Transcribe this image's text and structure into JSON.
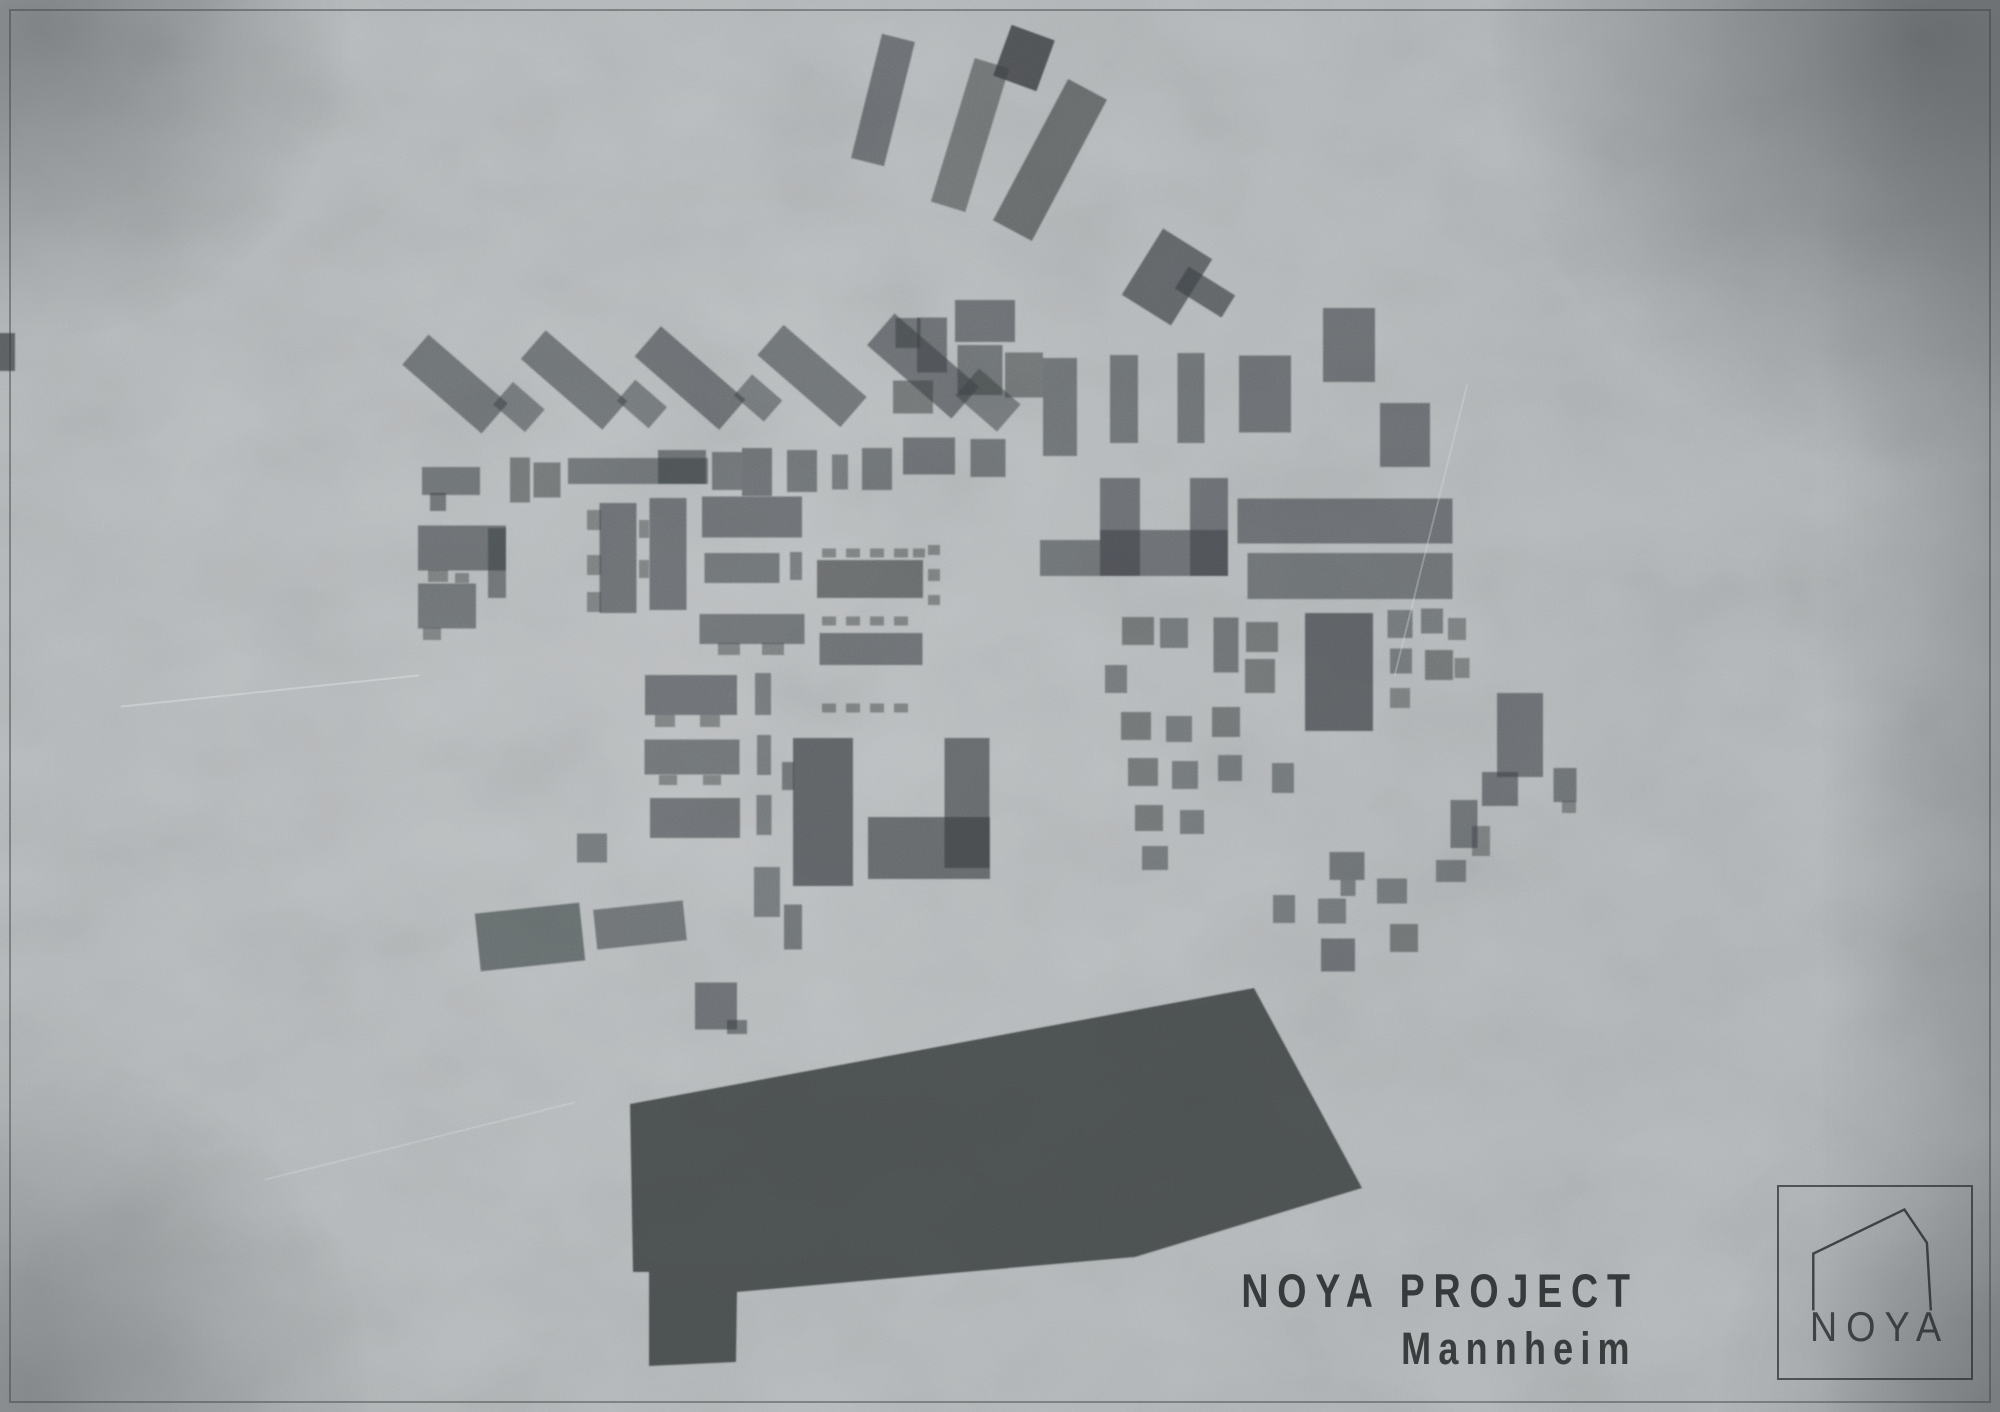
{
  "project": {
    "title": "NOYA PROJECT",
    "subtitle": "Mannheim"
  },
  "logo": {
    "text": "NOYA"
  },
  "colors": {
    "background": "#b4b8ba",
    "building": "#3c4043",
    "building_dark": "#2f3336",
    "ink": "#26292b",
    "frame": "#3b3e41"
  },
  "map": {
    "description": "figure-ground site plan of building footprints",
    "building_format": "[cx, cy, w, h, rotation_deg, opacity]",
    "buildings": [
      [
        883,
        100,
        34,
        128,
        14,
        0.62
      ],
      [
        970,
        135,
        36,
        150,
        17,
        0.58
      ],
      [
        1024,
        58,
        46,
        54,
        20,
        0.85
      ],
      [
        1050,
        160,
        44,
        160,
        28,
        0.66
      ],
      [
        1167,
        277,
        58,
        78,
        32,
        0.7
      ],
      [
        1205,
        292,
        55,
        26,
        32,
        0.7
      ],
      [
        455,
        384,
        105,
        40,
        41,
        0.6
      ],
      [
        519,
        407,
        42,
        30,
        41,
        0.55
      ],
      [
        574,
        380,
        108,
        38,
        41,
        0.6
      ],
      [
        642,
        404,
        42,
        28,
        41,
        0.55
      ],
      [
        690,
        378,
        112,
        40,
        41,
        0.62
      ],
      [
        758,
        398,
        40,
        28,
        41,
        0.55
      ],
      [
        812,
        376,
        110,
        40,
        41,
        0.6
      ],
      [
        923,
        366,
        112,
        42,
        41,
        0.62
      ],
      [
        988,
        400,
        55,
        36,
        41,
        0.55
      ],
      [
        908,
        333,
        25,
        30,
        0,
        0.6
      ],
      [
        932,
        345,
        30,
        55,
        0,
        0.62
      ],
      [
        985,
        321,
        60,
        42,
        0,
        0.62
      ],
      [
        980,
        370,
        45,
        50,
        0,
        0.6
      ],
      [
        1024,
        375,
        38,
        45,
        0,
        0.58
      ],
      [
        913,
        397,
        40,
        33,
        0,
        0.58
      ],
      [
        1060,
        407,
        34,
        98,
        0,
        0.6
      ],
      [
        1124,
        399,
        28,
        88,
        0,
        0.6
      ],
      [
        1191,
        398,
        27,
        90,
        0,
        0.6
      ],
      [
        1265,
        394,
        52,
        77,
        0,
        0.62
      ],
      [
        1349,
        345,
        52,
        74,
        0,
        0.62
      ],
      [
        1405,
        435,
        50,
        64,
        0,
        0.62
      ],
      [
        451,
        481,
        58,
        28,
        0,
        0.6
      ],
      [
        438,
        502,
        16,
        18,
        0,
        0.6
      ],
      [
        520,
        480,
        20,
        45,
        0,
        0.58
      ],
      [
        547,
        480,
        27,
        35,
        0,
        0.58
      ],
      [
        638,
        471,
        140,
        26,
        0,
        0.6
      ],
      [
        682,
        467,
        48,
        34,
        0,
        0.62
      ],
      [
        727,
        471,
        30,
        38,
        0,
        0.6
      ],
      [
        757,
        472,
        30,
        48,
        0,
        0.62
      ],
      [
        802,
        471,
        30,
        42,
        0,
        0.6
      ],
      [
        840,
        472,
        16,
        35,
        0,
        0.55
      ],
      [
        877,
        469,
        30,
        42,
        0,
        0.6
      ],
      [
        929,
        456,
        52,
        37,
        0,
        0.62
      ],
      [
        988,
        458,
        35,
        38,
        0,
        0.6
      ],
      [
        462,
        548,
        88,
        45,
        0,
        0.62
      ],
      [
        497,
        563,
        18,
        70,
        0,
        0.6
      ],
      [
        447,
        606,
        58,
        45,
        0,
        0.6
      ],
      [
        438,
        576,
        20,
        12,
        0,
        0.5
      ],
      [
        462,
        578,
        14,
        10,
        0,
        0.5
      ],
      [
        432,
        634,
        18,
        12,
        0,
        0.5
      ],
      [
        618,
        558,
        37,
        110,
        0,
        0.62
      ],
      [
        594,
        520,
        14,
        20,
        0,
        0.5
      ],
      [
        594,
        565,
        14,
        20,
        0,
        0.5
      ],
      [
        594,
        602,
        14,
        20,
        0,
        0.5
      ],
      [
        668,
        554,
        37,
        112,
        0,
        0.62
      ],
      [
        644,
        529,
        10,
        18,
        0,
        0.5
      ],
      [
        644,
        569,
        10,
        18,
        0,
        0.5
      ],
      [
        752,
        517,
        100,
        41,
        0,
        0.62
      ],
      [
        742,
        568,
        75,
        30,
        0,
        0.6
      ],
      [
        796,
        566,
        12,
        28,
        0,
        0.55
      ],
      [
        752,
        629,
        105,
        30,
        0,
        0.6
      ],
      [
        729,
        649,
        22,
        12,
        0,
        0.5
      ],
      [
        773,
        649,
        22,
        12,
        0,
        0.5
      ],
      [
        691,
        695,
        92,
        40,
        0,
        0.62
      ],
      [
        665,
        721,
        20,
        12,
        0,
        0.5
      ],
      [
        710,
        721,
        20,
        12,
        0,
        0.5
      ],
      [
        763,
        694,
        16,
        42,
        0,
        0.55
      ],
      [
        692,
        757,
        95,
        35,
        0,
        0.6
      ],
      [
        668,
        780,
        18,
        10,
        0,
        0.5
      ],
      [
        712,
        780,
        18,
        10,
        0,
        0.5
      ],
      [
        764,
        755,
        14,
        40,
        0,
        0.55
      ],
      [
        695,
        818,
        90,
        40,
        0,
        0.62
      ],
      [
        764,
        815,
        15,
        40,
        0,
        0.55
      ],
      [
        829,
        553,
        14,
        9,
        0,
        0.5
      ],
      [
        853,
        553,
        14,
        9,
        0,
        0.5
      ],
      [
        877,
        553,
        14,
        9,
        0,
        0.5
      ],
      [
        901,
        553,
        14,
        9,
        0,
        0.5
      ],
      [
        919,
        553,
        12,
        9,
        0,
        0.5
      ],
      [
        870,
        579,
        106,
        38,
        0,
        0.66
      ],
      [
        829,
        621,
        14,
        9,
        0,
        0.5
      ],
      [
        853,
        621,
        14,
        9,
        0,
        0.5
      ],
      [
        877,
        621,
        14,
        9,
        0,
        0.5
      ],
      [
        901,
        621,
        14,
        9,
        0,
        0.5
      ],
      [
        871,
        649,
        103,
        32,
        0,
        0.62
      ],
      [
        829,
        708,
        14,
        9,
        0,
        0.5
      ],
      [
        853,
        708,
        14,
        9,
        0,
        0.5
      ],
      [
        877,
        708,
        14,
        9,
        0,
        0.5
      ],
      [
        901,
        708,
        14,
        9,
        0,
        0.5
      ],
      [
        934,
        550,
        12,
        10,
        0,
        0.5
      ],
      [
        934,
        575,
        12,
        12,
        0,
        0.5
      ],
      [
        934,
        600,
        12,
        10,
        0,
        0.5
      ],
      [
        823,
        812,
        60,
        148,
        0,
        0.72
      ],
      [
        788,
        776,
        12,
        28,
        0,
        0.6
      ],
      [
        967,
        803,
        45,
        130,
        0,
        0.68
      ],
      [
        929,
        848,
        122,
        62,
        0,
        0.68
      ],
      [
        1120,
        527,
        40,
        98,
        0,
        0.62
      ],
      [
        1164,
        553,
        128,
        46,
        0,
        0.62
      ],
      [
        1209,
        527,
        38,
        98,
        0,
        0.62
      ],
      [
        1070,
        558,
        60,
        36,
        0,
        0.6
      ],
      [
        1345,
        521,
        215,
        45,
        0,
        0.62
      ],
      [
        1350,
        576,
        205,
        46,
        0,
        0.6
      ],
      [
        1339,
        672,
        68,
        118,
        0,
        0.72
      ],
      [
        1138,
        631,
        32,
        28,
        0,
        0.58
      ],
      [
        1174,
        633,
        28,
        30,
        0,
        0.55
      ],
      [
        1226,
        645,
        25,
        55,
        0,
        0.6
      ],
      [
        1262,
        637,
        32,
        30,
        0,
        0.58
      ],
      [
        1116,
        679,
        22,
        28,
        0,
        0.55
      ],
      [
        1260,
        676,
        30,
        34,
        0,
        0.58
      ],
      [
        1136,
        726,
        30,
        28,
        0,
        0.58
      ],
      [
        1179,
        729,
        26,
        26,
        0,
        0.55
      ],
      [
        1226,
        722,
        28,
        30,
        0,
        0.58
      ],
      [
        1143,
        772,
        30,
        28,
        0,
        0.58
      ],
      [
        1185,
        775,
        26,
        28,
        0,
        0.55
      ],
      [
        1230,
        768,
        24,
        26,
        0,
        0.55
      ],
      [
        1149,
        818,
        28,
        26,
        0,
        0.58
      ],
      [
        1192,
        822,
        24,
        24,
        0,
        0.55
      ],
      [
        1155,
        858,
        26,
        24,
        0,
        0.55
      ],
      [
        1400,
        624,
        25,
        28,
        0,
        0.55
      ],
      [
        1432,
        621,
        22,
        25,
        0,
        0.55
      ],
      [
        1457,
        629,
        18,
        22,
        0,
        0.5
      ],
      [
        1401,
        661,
        22,
        25,
        0,
        0.55
      ],
      [
        1439,
        665,
        28,
        30,
        0,
        0.58
      ],
      [
        1462,
        668,
        15,
        20,
        0,
        0.5
      ],
      [
        1400,
        698,
        20,
        20,
        0,
        0.5
      ],
      [
        1520,
        735,
        46,
        84,
        0,
        0.62
      ],
      [
        530,
        937,
        105,
        58,
        -6,
        0.65
      ],
      [
        640,
        925,
        90,
        40,
        -6,
        0.6
      ],
      [
        592,
        848,
        30,
        29,
        0,
        0.55
      ],
      [
        793,
        927,
        18,
        45,
        0,
        0.6
      ],
      [
        767,
        892,
        26,
        50,
        0,
        0.55
      ],
      [
        716,
        1006,
        42,
        47,
        0,
        0.62
      ],
      [
        737,
        1027,
        20,
        14,
        0,
        0.6
      ],
      [
        1283,
        778,
        22,
        30,
        0,
        0.55
      ],
      [
        1347,
        866,
        35,
        28,
        0,
        0.6
      ],
      [
        1348,
        888,
        15,
        16,
        0,
        0.55
      ],
      [
        1332,
        911,
        28,
        25,
        0,
        0.55
      ],
      [
        1284,
        909,
        22,
        28,
        0,
        0.55
      ],
      [
        1338,
        955,
        34,
        33,
        0,
        0.62
      ],
      [
        1392,
        891,
        30,
        25,
        0,
        0.55
      ],
      [
        1404,
        938,
        28,
        28,
        0,
        0.58
      ],
      [
        1451,
        871,
        30,
        22,
        0,
        0.55
      ],
      [
        1464,
        824,
        27,
        48,
        0,
        0.6
      ],
      [
        1481,
        841,
        18,
        30,
        0,
        0.5
      ],
      [
        1500,
        789,
        36,
        34,
        0,
        0.62
      ],
      [
        1565,
        785,
        23,
        34,
        0,
        0.6
      ],
      [
        1569,
        807,
        14,
        12,
        0,
        0.5
      ],
      [
        6,
        352,
        18,
        38,
        0,
        0.75
      ]
    ],
    "polygons": [
      {
        "name": "main-hall-footprint",
        "points": "630,1104 1254,988 1362,1188 1135,1257 737,1292 736,1362 649,1366 649,1272 633,1272",
        "opacity": 0.8
      }
    ]
  }
}
